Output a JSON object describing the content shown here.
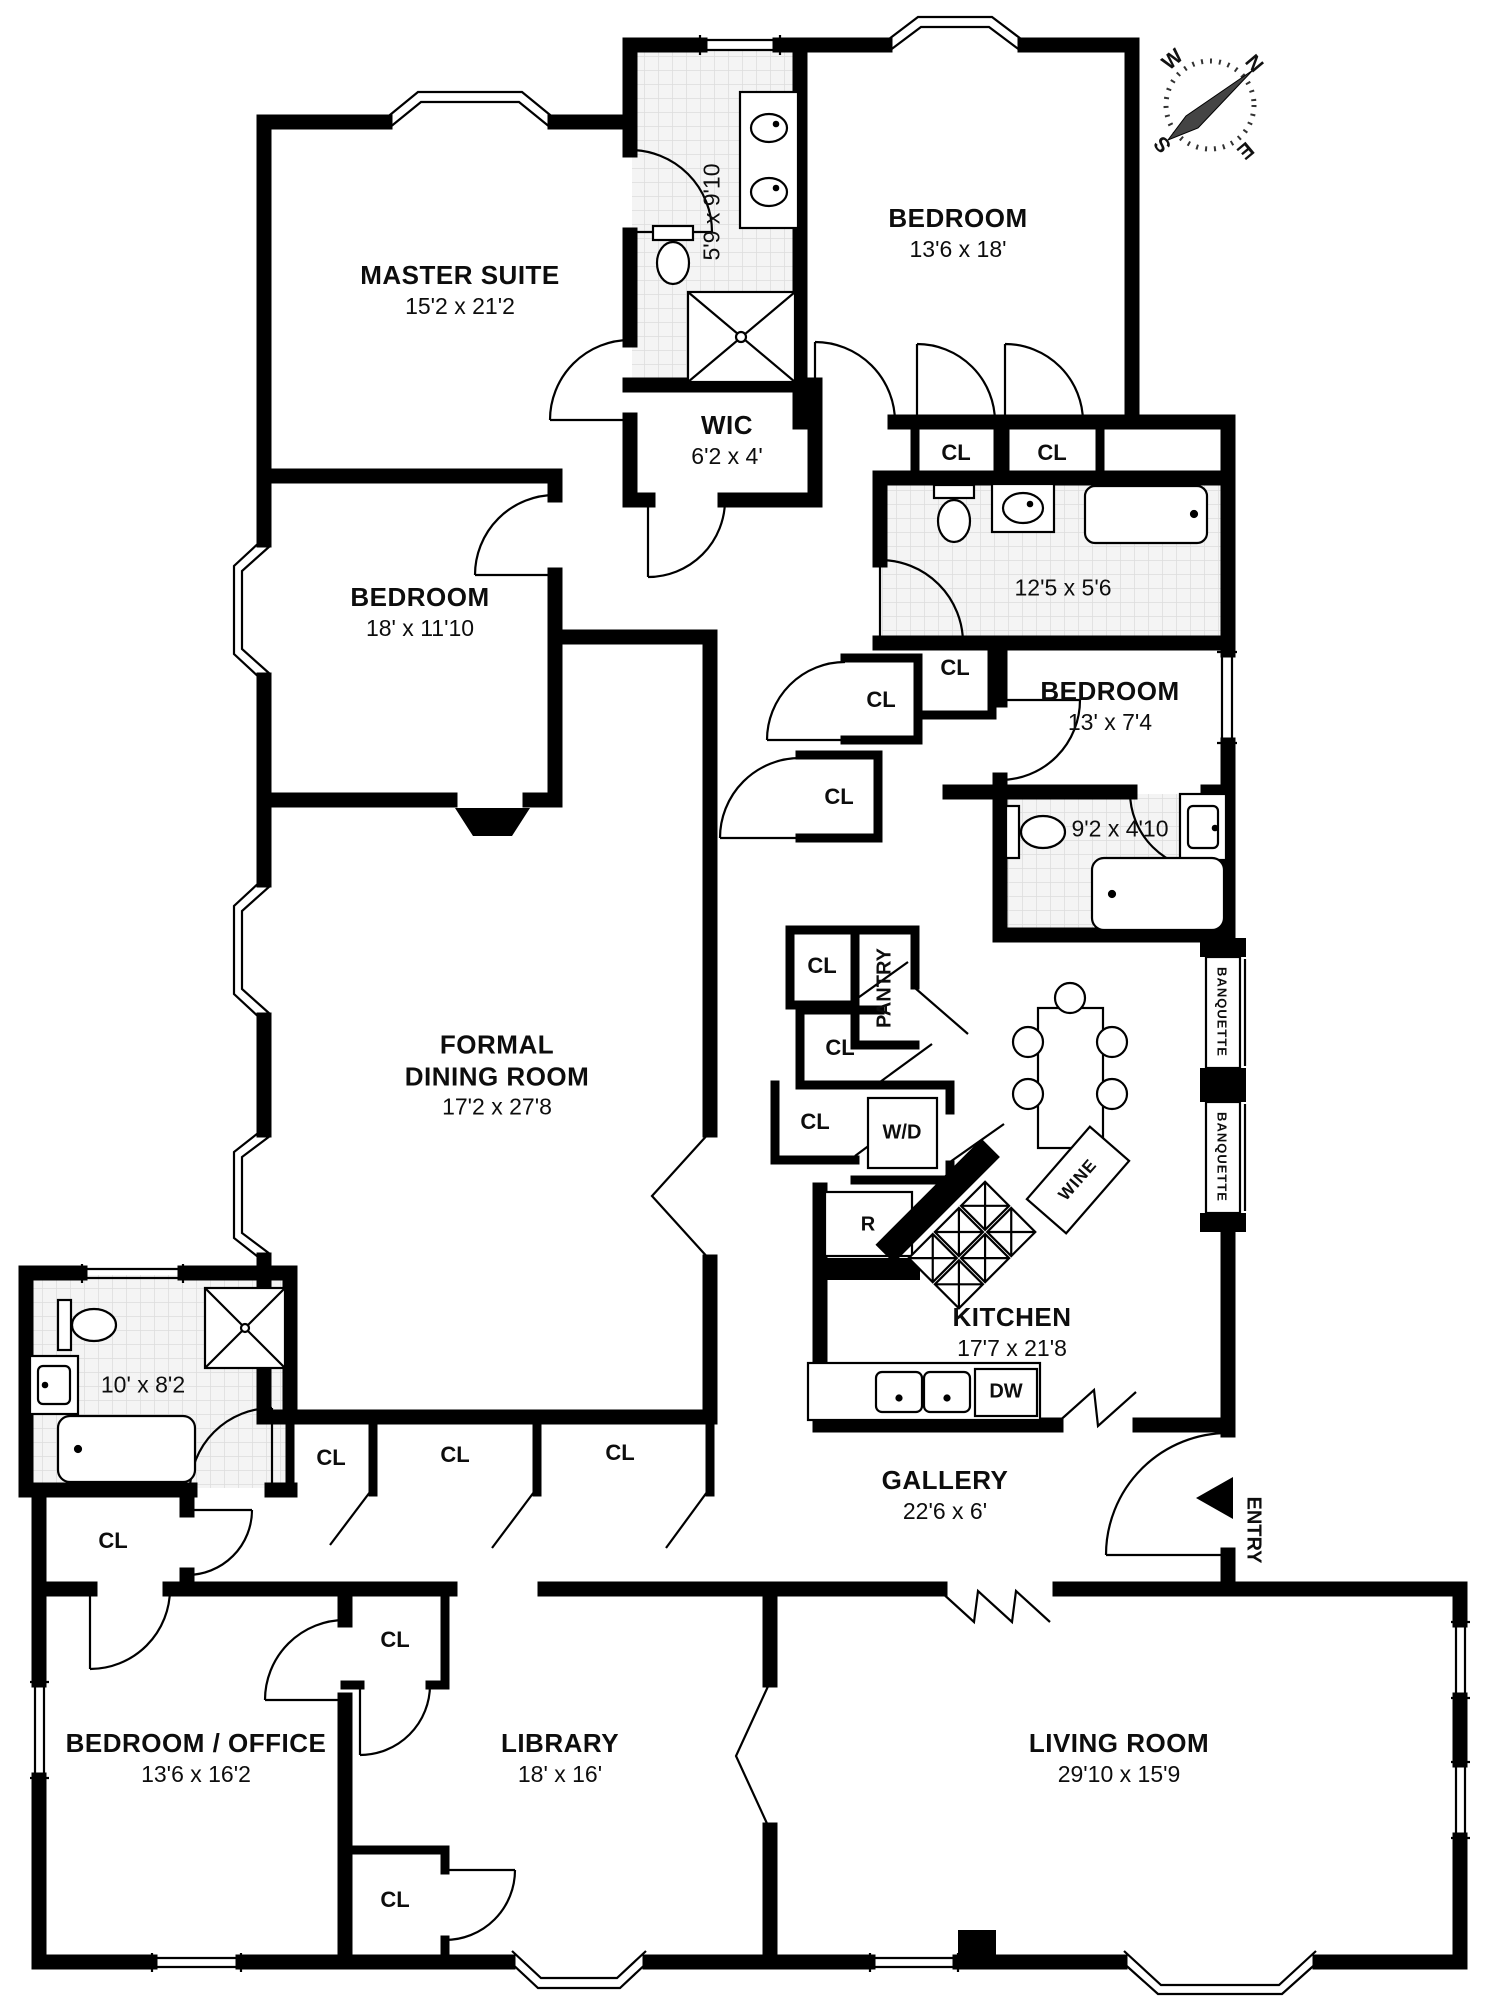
{
  "plan": {
    "compass": {
      "n": "N",
      "e": "E",
      "s": "S",
      "w": "W"
    },
    "rooms": {
      "master_suite": {
        "name": "MASTER SUITE",
        "dims": "15'2 x 21'2"
      },
      "bedroom_top": {
        "name": "BEDROOM",
        "dims": "13'6 x 18'"
      },
      "master_bath": {
        "dims": "5'9 x 9'10"
      },
      "wic": {
        "name": "WIC",
        "dims": "6'2 x 4'"
      },
      "hall_bath": {
        "dims": "12'5 x 5'6"
      },
      "bedroom_left": {
        "name": "BEDROOM",
        "dims": "18' x 11'10"
      },
      "bedroom_small": {
        "name": "BEDROOM",
        "dims": "13' x 7'4"
      },
      "small_bath": {
        "dims": "9'2 x 4'10"
      },
      "formal_dining": {
        "name_line1": "FORMAL",
        "name_line2": "DINING ROOM",
        "dims": "17'2 x 27'8"
      },
      "kitchen": {
        "name": "KITCHEN",
        "dims": "17'7 x 21'8"
      },
      "left_bath": {
        "dims": "10' x 8'2"
      },
      "gallery": {
        "name": "GALLERY",
        "dims": "22'6 x 6'"
      },
      "bedroom_office": {
        "name": "BEDROOM / OFFICE",
        "dims": "13'6 x 16'2"
      },
      "library": {
        "name": "LIBRARY",
        "dims": "18' x 16'"
      },
      "living_room": {
        "name": "LIVING ROOM",
        "dims": "29'10 x 15'9"
      }
    },
    "labels": {
      "closet": "CL",
      "pantry": "PANTRY",
      "washer_dryer": "W/D",
      "refrigerator": "R",
      "dishwasher": "DW",
      "wine": "WINE",
      "banquette": "BANQUETTE",
      "entry": "ENTRY"
    },
    "colors": {
      "wall": "#000000",
      "background": "#ffffff",
      "tile_fill": "#f4f4f4",
      "tile_line": "#dcdcdc"
    }
  }
}
